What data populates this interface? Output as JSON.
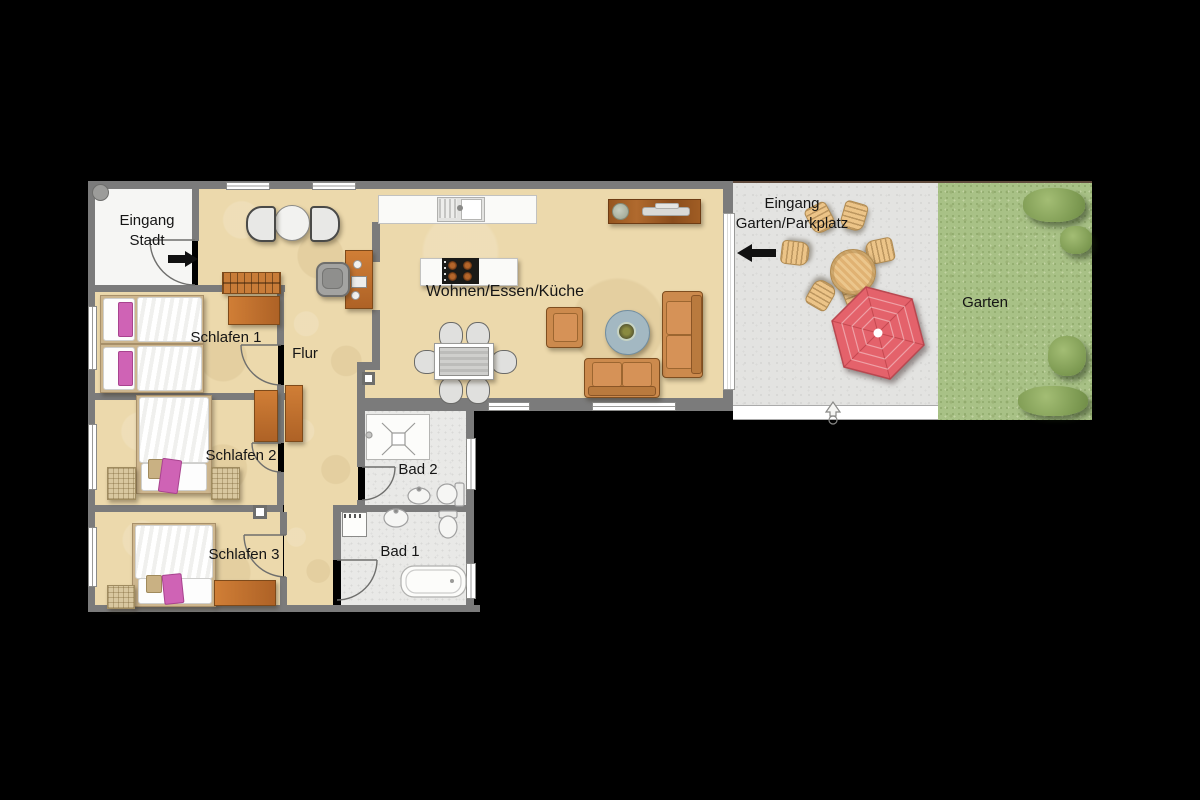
{
  "plan": {
    "rooms": {
      "eingang_stadt": {
        "label": "Eingang\nStadt"
      },
      "flur": {
        "label": "Flur"
      },
      "schlafen_1": {
        "label": "Schlafen 1"
      },
      "schlafen_2": {
        "label": "Schlafen 2"
      },
      "schlafen_3": {
        "label": "Schlafen 3"
      },
      "bad_1": {
        "label": "Bad 1"
      },
      "bad_2": {
        "label": "Bad 2"
      },
      "wohnen": {
        "label": "Wohnen/Essen/Küche"
      },
      "terrasse": {
        "label": "Eingang\nGarten/Parkplatz"
      },
      "garten": {
        "label": "Garten"
      }
    },
    "icons": {
      "entry_city_arrow": "right-arrow",
      "terrace_arrow": "left-arrow",
      "north_marker": "north-arrow"
    },
    "colors": {
      "background": "#000000",
      "wall": "#7b7b7b",
      "floor": "#ecd9ac",
      "entry_floor": "#f6f6f4",
      "bath_floor": "#e9e9e7",
      "terrace": "#e3e3e1",
      "garden": "#a8c186",
      "wood": "#c4782f",
      "sofa": "#cc8a4d",
      "parasol": "#e4626b",
      "pink_accent": "#cf63b5",
      "coffee_table": "#a3b8c2"
    }
  }
}
